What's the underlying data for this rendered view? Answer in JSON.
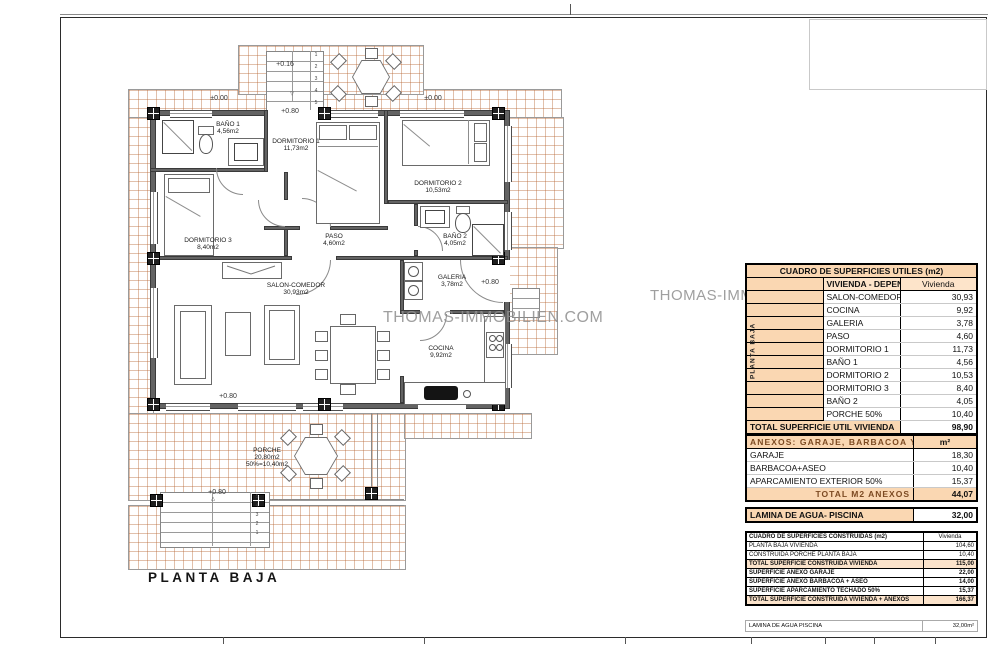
{
  "watermark": {
    "text": "THOMAS-IMMOBILIEN.COM",
    "text2": "THOMAS-IMMOBILIEN.COM",
    "color": "#8f8f8f"
  },
  "colors": {
    "accent_peach": "#fad7b2",
    "tile_line": "#b76837",
    "wall": "#3a3a3a"
  },
  "plan": {
    "title": "PLANTA BAJA",
    "labels": [
      {
        "t": "BAÑO 1",
        "x": 228,
        "y": 122
      },
      {
        "t": "4,56m2",
        "x": 228,
        "y": 129
      },
      {
        "t": "DORMITORIO 1",
        "x": 296,
        "y": 139
      },
      {
        "t": "11,73m2",
        "x": 296,
        "y": 146
      },
      {
        "t": "DORMITORIO 2",
        "x": 438,
        "y": 181
      },
      {
        "t": "10,53m2",
        "x": 438,
        "y": 188
      },
      {
        "t": "DORMITORIO 3",
        "x": 208,
        "y": 238
      },
      {
        "t": "8,40m2",
        "x": 208,
        "y": 245
      },
      {
        "t": "PASO",
        "x": 334,
        "y": 234
      },
      {
        "t": "4,60m2",
        "x": 334,
        "y": 241
      },
      {
        "t": "BAÑO 2",
        "x": 455,
        "y": 234
      },
      {
        "t": "4,05m2",
        "x": 455,
        "y": 241
      },
      {
        "t": "SALON-COMEDOR",
        "x": 296,
        "y": 283
      },
      {
        "t": "30,93m2",
        "x": 296,
        "y": 290
      },
      {
        "t": "GALERIA",
        "x": 452,
        "y": 275
      },
      {
        "t": "3,78m2",
        "x": 452,
        "y": 282
      },
      {
        "t": "COCINA",
        "x": 441,
        "y": 346
      },
      {
        "t": "9,92m2",
        "x": 441,
        "y": 353
      },
      {
        "t": "PORCHE",
        "x": 267,
        "y": 448
      },
      {
        "t": "20,80m2",
        "x": 267,
        "y": 455
      },
      {
        "t": "50%=10,40m2",
        "x": 267,
        "y": 462
      },
      {
        "t": "±0.00",
        "x": 219,
        "y": 95,
        "cls": "lvl"
      },
      {
        "t": "±0.00",
        "x": 433,
        "y": 95,
        "cls": "lvl"
      },
      {
        "t": "+0.16",
        "x": 285,
        "y": 61,
        "cls": "lvl"
      },
      {
        "t": "+0.80",
        "x": 290,
        "y": 108,
        "cls": "lvl"
      },
      {
        "t": "+0.80",
        "x": 490,
        "y": 279,
        "cls": "lvl"
      },
      {
        "t": "+0.80",
        "x": 228,
        "y": 393,
        "cls": "lvl"
      },
      {
        "t": "+0.80",
        "x": 217,
        "y": 489,
        "cls": "lvl"
      },
      {
        "t": "1",
        "x": 316,
        "y": 53,
        "cls": "dig"
      },
      {
        "t": "2",
        "x": 316,
        "y": 65,
        "cls": "dig"
      },
      {
        "t": "3",
        "x": 316,
        "y": 77,
        "cls": "dig"
      },
      {
        "t": "4",
        "x": 316,
        "y": 89,
        "cls": "dig"
      },
      {
        "t": "5",
        "x": 316,
        "y": 101,
        "cls": "dig"
      },
      {
        "t": "▽",
        "x": 292,
        "y": 92,
        "cls": "dig"
      },
      {
        "t": "5",
        "x": 257,
        "y": 495,
        "cls": "dig"
      },
      {
        "t": "4",
        "x": 257,
        "y": 504,
        "cls": "dig"
      },
      {
        "t": "3",
        "x": 257,
        "y": 513,
        "cls": "dig"
      },
      {
        "t": "2",
        "x": 257,
        "y": 522,
        "cls": "dig"
      },
      {
        "t": "1",
        "x": 257,
        "y": 531,
        "cls": "dig"
      },
      {
        "t": "△",
        "x": 213,
        "y": 497,
        "cls": "dig"
      }
    ]
  },
  "tables": {
    "utiles": {
      "title": "CUADRO DE SUPERFICIES UTILES (m2)",
      "side_label": "PLANTA BAJA",
      "col1": "VIVIENDA - DEPENDENCIAS",
      "col2": "Vivienda",
      "rows": [
        {
          "label": "SALON-COMEDOR",
          "value": "30,93"
        },
        {
          "label": "COCINA",
          "value": "9,92"
        },
        {
          "label": "GALERIA",
          "value": "3,78"
        },
        {
          "label": "PASO",
          "value": "4,60"
        },
        {
          "label": "DORMITORIO 1",
          "value": "11,73"
        },
        {
          "label": "BAÑO 1",
          "value": "4,56"
        },
        {
          "label": "DORMITORIO 2",
          "value": "10,53"
        },
        {
          "label": "DORMITORIO 3",
          "value": "8,40"
        },
        {
          "label": "BAÑO 2",
          "value": "4,05"
        },
        {
          "label": "PORCHE 50%",
          "value": "10,40"
        }
      ],
      "total_label": "TOTAL SUPERFICIE UTIL VIVIENDA",
      "total_value": "98,90"
    },
    "anexos": {
      "header": "ANEXOS: GARAJE, BARBACOA Y APARCAMIENTO",
      "unit": "m²",
      "rows": [
        {
          "label": "GARAJE",
          "value": "18,30"
        },
        {
          "label": "BARBACOA+ASEO",
          "value": "10,40"
        },
        {
          "label": "APARCAMIENTO EXTERIOR 50%",
          "value": "15,37"
        }
      ],
      "total_label": "TOTAL M2 ANEXOS",
      "total_value": "44,07"
    },
    "lamina": {
      "label": "LAMINA DE AGUA- PISCINA",
      "value": "32,00"
    },
    "construidas": {
      "title": "CUADRO DE SUPERFICIES CONSTRUIDAS (m2)",
      "col2": "Vivienda",
      "rows": [
        {
          "label": "PLANTA BAJA VIVIENDA",
          "value": "104,60",
          "cls": ""
        },
        {
          "label": "CONSTRUIDA PORCHE PLANTA BAJA",
          "value": "10,40",
          "cls": ""
        },
        {
          "label": "TOTAL SUPERFICIE CONSTRUIDA VIVIENDA",
          "value": "115,00",
          "cls": "em shade"
        },
        {
          "label": "SUPERFICIE ANEXO GARAJE",
          "value": "22,00",
          "cls": "em"
        },
        {
          "label": "SUPERFICIE ANEXO BARBACOA + ASEO",
          "value": "14,00",
          "cls": "em"
        },
        {
          "label": "SUPERFICIE APARCAMIENTO TECHADO 50%",
          "value": "15,37",
          "cls": "em"
        },
        {
          "label": "TOTAL SUPERFICIE CONSTRUIDA VIVIENDA + ANEXOS",
          "value": "166,37",
          "cls": "em shade"
        }
      ]
    },
    "lamina2": {
      "label": "LAMINA DE AGUA PISCINA",
      "value": "32,00m²"
    }
  }
}
